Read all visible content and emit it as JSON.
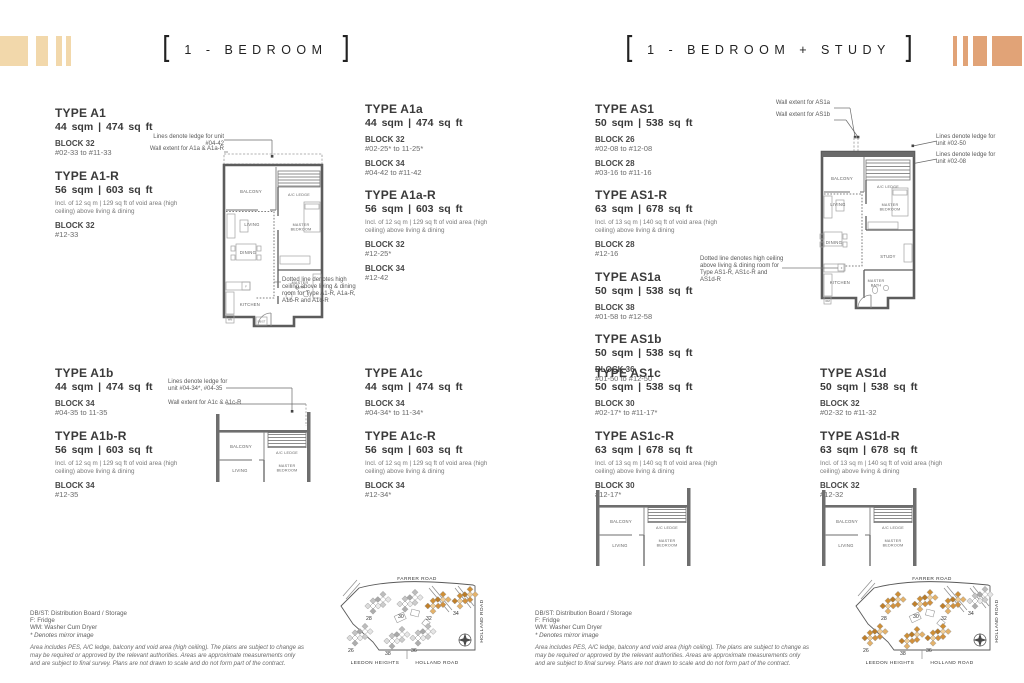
{
  "titles": {
    "bracket_open": "[",
    "bracket_close": "]",
    "left": "1 - BEDROOM",
    "right": "1 - BEDROOM + STUDY"
  },
  "colors": {
    "deco_left": "#f2d8ab",
    "deco_right": "#e1a377",
    "map_highlight": "#d2913d"
  },
  "unit_groups": [
    {
      "id": "a1",
      "types": [
        {
          "name": "TYPE A1",
          "area": "44 sqm | 474 sq ft",
          "blocks": [
            {
              "block": "BLOCK 32",
              "range": "#02-33 to #11-33"
            }
          ]
        },
        {
          "name": "TYPE A1-R",
          "area": "56 sqm | 603 sq ft",
          "note": "Incl. of 12 sq m | 129 sq ft of void area (high ceiling) above living & dining",
          "blocks": [
            {
              "block": "BLOCK 32",
              "range": "#12-33"
            }
          ]
        }
      ]
    },
    {
      "id": "a1a",
      "types": [
        {
          "name": "TYPE A1a",
          "area": "44 sqm | 474 sq ft",
          "blocks": [
            {
              "block": "BLOCK 32",
              "range": "#02-25* to 11-25*"
            },
            {
              "block": "BLOCK 34",
              "range": "#04-42 to #11-42"
            }
          ]
        },
        {
          "name": "TYPE A1a-R",
          "area": "56 sqm | 603 sq ft",
          "note": "Incl. of 12 sq m | 129 sq ft of void area (high ceiling) above living & dining",
          "blocks": [
            {
              "block": "BLOCK 32",
              "range": "#12-25*"
            },
            {
              "block": "BLOCK 34",
              "range": "#12-42"
            }
          ]
        }
      ]
    },
    {
      "id": "a1b",
      "types": [
        {
          "name": "TYPE A1b",
          "area": "44 sqm | 474 sq ft",
          "blocks": [
            {
              "block": "BLOCK 34",
              "range": "#04-35 to 11-35"
            }
          ]
        },
        {
          "name": "TYPE A1b-R",
          "area": "56 sqm | 603 sq ft",
          "note": "Incl. of 12 sq m | 129 sq ft of void area (high ceiling) above living & dining",
          "blocks": [
            {
              "block": "BLOCK 34",
              "range": "#12-35"
            }
          ]
        }
      ]
    },
    {
      "id": "a1c",
      "types": [
        {
          "name": "TYPE A1c",
          "area": "44 sqm | 474 sq ft",
          "blocks": [
            {
              "block": "BLOCK 34",
              "range": "#04-34* to 11-34*"
            }
          ]
        },
        {
          "name": "TYPE A1c-R",
          "area": "56 sqm | 603 sq ft",
          "note": "Incl. of 12 sq m | 129 sq ft of void area (high ceiling) above living & dining",
          "blocks": [
            {
              "block": "BLOCK 34",
              "range": "#12-34*"
            }
          ]
        }
      ]
    },
    {
      "id": "as1",
      "types": [
        {
          "name": "TYPE AS1",
          "area": "50 sqm | 538 sq ft",
          "blocks": [
            {
              "block": "BLOCK 26",
              "range": "#02-08 to #12-08"
            },
            {
              "block": "BLOCK 28",
              "range": "#03-16 to #11-16"
            }
          ]
        },
        {
          "name": "TYPE AS1-R",
          "area": "63 sqm | 678 sq ft",
          "note": "Incl. of 13 sq m | 140 sq ft of void area (high ceiling) above living & dining",
          "blocks": [
            {
              "block": "BLOCK 28",
              "range": "#12-16"
            }
          ]
        },
        {
          "name": "TYPE AS1a",
          "area": "50 sqm | 538 sq ft",
          "blocks": [
            {
              "block": "BLOCK 38",
              "range": "#01-58 to #12-58"
            }
          ]
        },
        {
          "name": "TYPE AS1b",
          "area": "50 sqm | 538 sq ft",
          "blocks": [
            {
              "block": "BLOCK 36",
              "range": "#01-50 to #12-50"
            }
          ]
        }
      ]
    },
    {
      "id": "as1c",
      "types": [
        {
          "name": "TYPE AS1c",
          "area": "50 sqm | 538 sq ft",
          "blocks": [
            {
              "block": "BLOCK 30",
              "range": "#02-17* to #11-17*"
            }
          ]
        },
        {
          "name": "TYPE AS1c-R",
          "area": "63 sqm | 678 sq ft",
          "note": "Incl. of 13 sq m | 140 sq ft of void area (high ceiling) above living & dining",
          "blocks": [
            {
              "block": "BLOCK 30",
              "range": "#12-17*"
            }
          ]
        }
      ]
    },
    {
      "id": "as1d",
      "types": [
        {
          "name": "TYPE AS1d",
          "area": "50 sqm | 538 sq ft",
          "blocks": [
            {
              "block": "BLOCK 32",
              "range": "#02-32 to #11-32"
            }
          ]
        },
        {
          "name": "TYPE AS1d-R",
          "area": "63 sqm | 678 sq ft",
          "note": "Incl. of 13 sq m | 140 sq ft of void area (high ceiling) above living & dining",
          "blocks": [
            {
              "block": "BLOCK 32",
              "range": "#12-32"
            }
          ]
        }
      ]
    }
  ],
  "annotations": {
    "a1_ledge": "Lines denote ledge for unit #04-42",
    "a1_wall": "Wall extent for A1a & A1a-R",
    "a1_dotted": "Dotted line denotes high ceiling above living & dining room for Type A1-R, A1a-R, A1b-R and A1c-R",
    "a1bc_ledge": "Lines denote ledge for unit #04-34*, #04-35",
    "a1bc_wall": "Wall extent for A1c & A1c-R",
    "as1_wall_a": "Wall extent for AS1a",
    "as1_wall_b": "Wall extent for AS1b",
    "as1_ledge_1": "Lines denote ledge for unit #02-50",
    "as1_ledge_2": "Lines denote ledge for unit #02-08",
    "as1_dotted": "Dotted line denotes high ceiling above living & dining room for Type AS1-R, AS1c-R and AS1d-R"
  },
  "plan_labels": {
    "balcony": "BALCONY",
    "ac_ledge": "A/C LEDGE",
    "living": "LIVING",
    "dining": "DINING",
    "kitchen": "KITCHEN",
    "master": "MASTER",
    "bedroom": "BEDROOM",
    "bath": "BATH",
    "study": "STUDY",
    "f": "F",
    "wm": "WM",
    "dbst": "DB/ST"
  },
  "legend": {
    "lines": [
      "DB/ST: Distribution Board / Storage",
      "F: Fridge",
      "WM: Washer Cum Dryer",
      "* Denotes mirror image"
    ],
    "disclaimer": "Area includes PES, A/C ledge, balcony and void area (high ceiling). The plans are subject to change as may be required or approved by the relevant authorities. Areas are approximate measurements only and are subject to final survey. Plans are not drawn to scale and do not form part of the contract."
  },
  "site_map": {
    "roads": {
      "top": "FARRER ROAD",
      "right": "HOLLAND ROAD",
      "bottom_left": "LEEDON HEIGHTS",
      "bottom_right": "HOLLAND ROAD"
    },
    "left_blocks": [
      {
        "n": "28",
        "hl": false
      },
      {
        "n": "30",
        "hl": false
      },
      {
        "n": "32",
        "hl": true
      },
      {
        "n": "34",
        "hl": true
      },
      {
        "n": "26",
        "hl": false
      },
      {
        "n": "38",
        "hl": false
      },
      {
        "n": "36",
        "hl": false
      }
    ],
    "right_blocks": [
      {
        "n": "28",
        "hl": true
      },
      {
        "n": "30",
        "hl": true
      },
      {
        "n": "32",
        "hl": true
      },
      {
        "n": "34",
        "hl": false
      },
      {
        "n": "26",
        "hl": true
      },
      {
        "n": "38",
        "hl": true
      },
      {
        "n": "36",
        "hl": true
      }
    ]
  }
}
